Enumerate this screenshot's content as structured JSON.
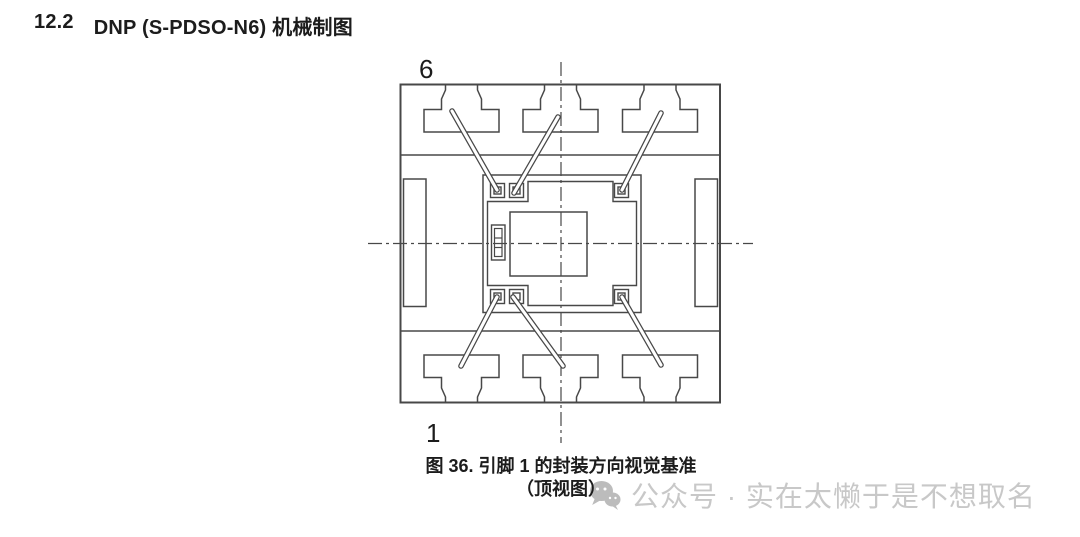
{
  "heading": {
    "section_number": "12.2",
    "title": "DNP (S-PDSO-N6) 机械制图"
  },
  "figure": {
    "top_pin_label": "6",
    "bottom_pin_label": "1",
    "caption_title": "图 36. 引脚 1 的封装方向视觉基准",
    "caption_subtitle": "（顶视图）",
    "view": "top-view-package-drawing",
    "pin_count_shown": 6
  },
  "watermark": {
    "icon": "wechat-icon",
    "text": "公众号 · 实在太懒于是不想取名"
  },
  "colors": {
    "line": "#484848",
    "text": "#1c1c1c",
    "watermark_text": "#c8c8c8",
    "watermark_icon": "#bcbcbc",
    "background": "#ffffff"
  }
}
